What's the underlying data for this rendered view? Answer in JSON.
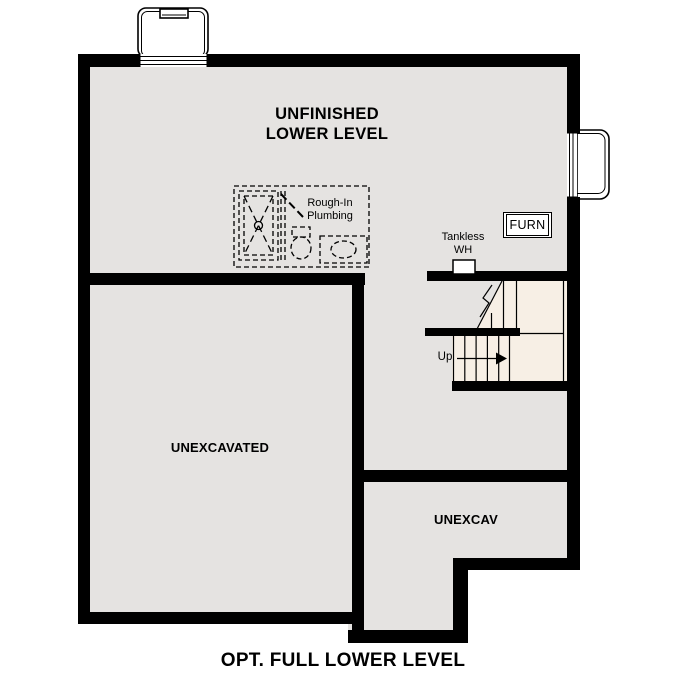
{
  "plan": {
    "title": "OPT. FULL LOWER LEVEL",
    "rooms": {
      "unfinished_lower_level": {
        "line1": "UNFINISHED",
        "line2": "LOWER LEVEL"
      },
      "unexcavated": "UNEXCAVATED",
      "unexcav": "UNEXCAV"
    },
    "annotations": {
      "rough_in_plumbing": {
        "line1": "Rough-In",
        "line2": "Plumbing"
      },
      "tankless_wh": {
        "line1": "Tankless",
        "line2": "WH"
      },
      "furnace": "FURN",
      "stairs_up": "Up"
    },
    "colors": {
      "wall": "#000000",
      "floor": "#e5e3e1",
      "stair_floor": "#f7efe5",
      "background": "#ffffff"
    }
  }
}
